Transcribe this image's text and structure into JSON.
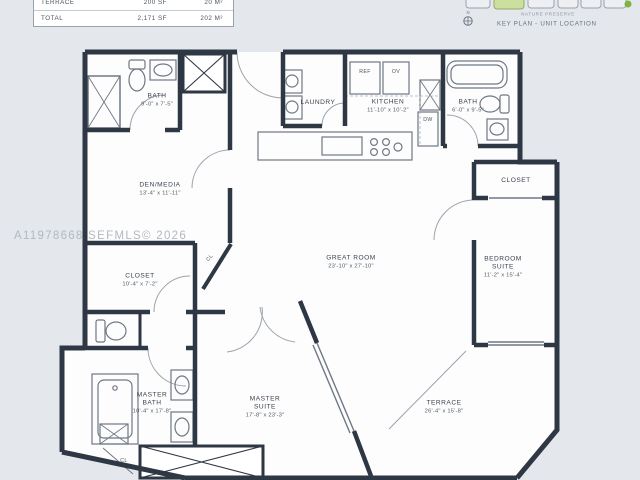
{
  "area_table": {
    "rows": [
      {
        "label": "TERRACE",
        "sf": "200 SF",
        "m2": "20 M²"
      },
      {
        "label": "TOTAL",
        "sf": "2,171 SF",
        "m2": "202 M²"
      }
    ]
  },
  "key_plan": {
    "north": "N",
    "nature_preserve": "NATURE PRESERVE",
    "caption": "KEY PLAN - UNIT LOCATION",
    "highlight_color": "#ccdf9f"
  },
  "watermark": "A11978668 SEFMLS© 2026",
  "rooms": {
    "bath_1": {
      "name": "BATH",
      "dims": "9'-0\" x 7'-5\""
    },
    "laundry": {
      "name": "LAUNDRY"
    },
    "kitchen": {
      "name": "KITCHEN",
      "dims": "11'-10\" x 10'-2\""
    },
    "bath_2": {
      "name": "BATH",
      "dims": "6'-0\" x 9'-5\""
    },
    "closet_right": {
      "name": "CLOSET"
    },
    "den_media": {
      "name": "DEN/MEDIA",
      "dims": "13'-4\" x 11'-11\""
    },
    "great_room": {
      "name": "GREAT ROOM",
      "dims": "23'-10\" x 27'-10\""
    },
    "bedroom_suite": {
      "name": "BEDROOM SUITE",
      "dims": "11'-2\" x 15'-4\""
    },
    "closet_left": {
      "name": "CLOSET",
      "dims": "10'-4\" x 7'-2\""
    },
    "master_bath": {
      "name": "MASTER BATH",
      "dims": "10'-4\" x 17'-8\""
    },
    "master_suite": {
      "name": "MASTER SUITE",
      "dims": "17'-8\" x 23'-3\""
    },
    "terrace": {
      "name": "TERRACE",
      "dims": "26'-4\" x 15'-8\""
    },
    "cl_hall": {
      "label": "CL"
    },
    "cl_bottom": {
      "label": "CL"
    }
  },
  "appliances": {
    "ref": "REF",
    "oven": "OV",
    "dishwasher": "DW"
  },
  "colors": {
    "wall": "#2e3744",
    "background": "#e4e7ec",
    "room": "#fdfdfd"
  }
}
